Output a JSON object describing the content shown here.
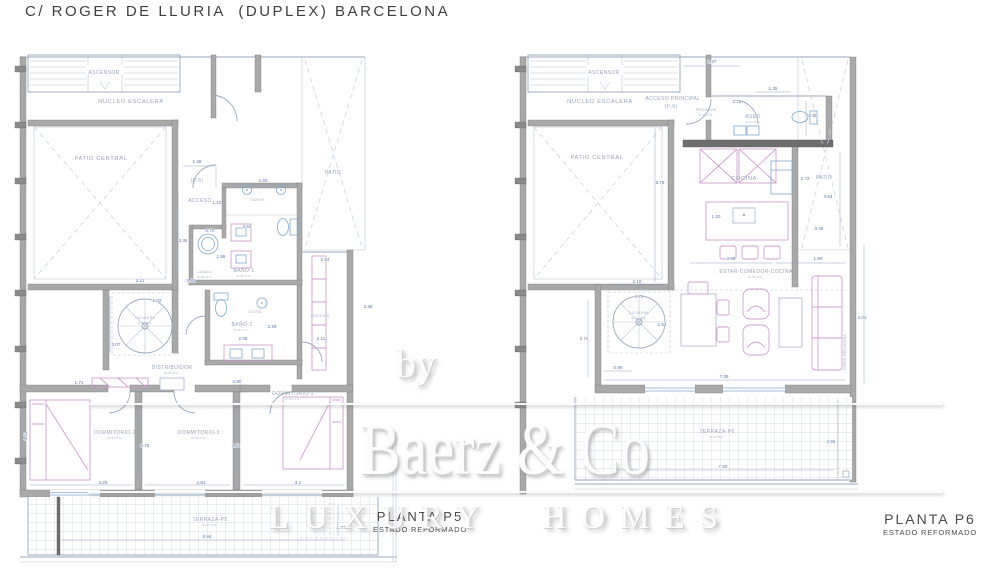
{
  "title": "C/ ROGER DE LLURIA  (DUPLEX) BARCELONA",
  "watermark": {
    "prefix": "by",
    "brand": "Baerz & Co",
    "tagline": "LUXURY HOMES"
  },
  "captions": {
    "p5": {
      "name": "PLANTA P5",
      "state": "ESTADO REFORMADO"
    },
    "p6": {
      "name": "PLANTA P6",
      "state": "ESTADO REFORMADO"
    }
  },
  "colors": {
    "wall": "#a9a9a9",
    "line": "#9aa7bd",
    "dimension": "#5f74a8",
    "furniture": "#d19fd0",
    "fixture": "#7fa9cf",
    "tile": "#c8d0da",
    "ink": "#3f3f3f"
  },
  "p5": {
    "labels": {
      "ascensor": "ASCENSOR",
      "nucleo": "NUCLEO ESCALERA",
      "patio_central": "PATIO CENTRAL",
      "patio": "PATIO",
      "pref": "(P-5)",
      "acceso": "ACCESO",
      "ducha": "DUCHA",
      "bano1": "BAÑO-1",
      "lavado": "LAVADO",
      "bano2": "BAÑO-2",
      "escalera": "ESCALERA",
      "distribuidor": "DISTRIBUIDOR",
      "vestidor": "VESTIDOR",
      "dorm1": "DORMITORIO-1",
      "dorm2": "DORMITORIO-2",
      "dorm3": "DORMITORIO-3",
      "terraza": "TERRAZA-P5",
      "sup": "SUP.UTIL."
    },
    "dims": [
      "1.48",
      "1.93",
      "1.10",
      "0.70",
      "3.52",
      "1.86",
      "3.36",
      "1.54",
      "3.36",
      "2.11",
      "2.06",
      "2.29",
      "0.92",
      "2.11",
      "1.02",
      "3.07",
      "0.90",
      "1.71",
      "3.51",
      "2.76",
      "2.72",
      "3.29",
      "2.81",
      "3.1",
      "8.84",
      "1.77"
    ]
  },
  "p6": {
    "labels": {
      "ascensor": "ASCENSOR",
      "nucleo": "NUCLEO ESCALERA",
      "acceso": "ACCESO PRINCIPAL",
      "pref": "(P-6)",
      "recibidor": "RECIBIDOR",
      "aseo": "ASEO",
      "patio_central": "PATIO CENTRAL",
      "cocina": "COCINA",
      "patio": "PATIO",
      "estar": "ESTAR-COMEDOR-COCINA",
      "escalera": "ESCALERA",
      "terraza": "TERRAZA-P6",
      "pared": "PARED MEDIANERA",
      "sup": "SUP.UTIL."
    },
    "dims": [
      "2.27",
      "1.35",
      "1.75",
      "0.90",
      "6.78",
      "2.72",
      "3.64",
      "1.20",
      "0.45",
      "3.69",
      "1.60",
      "2.10",
      "1.79",
      "1.54",
      "2.74",
      "0.90",
      "7.39",
      "4.03",
      "7.50",
      "2.65"
    ]
  }
}
